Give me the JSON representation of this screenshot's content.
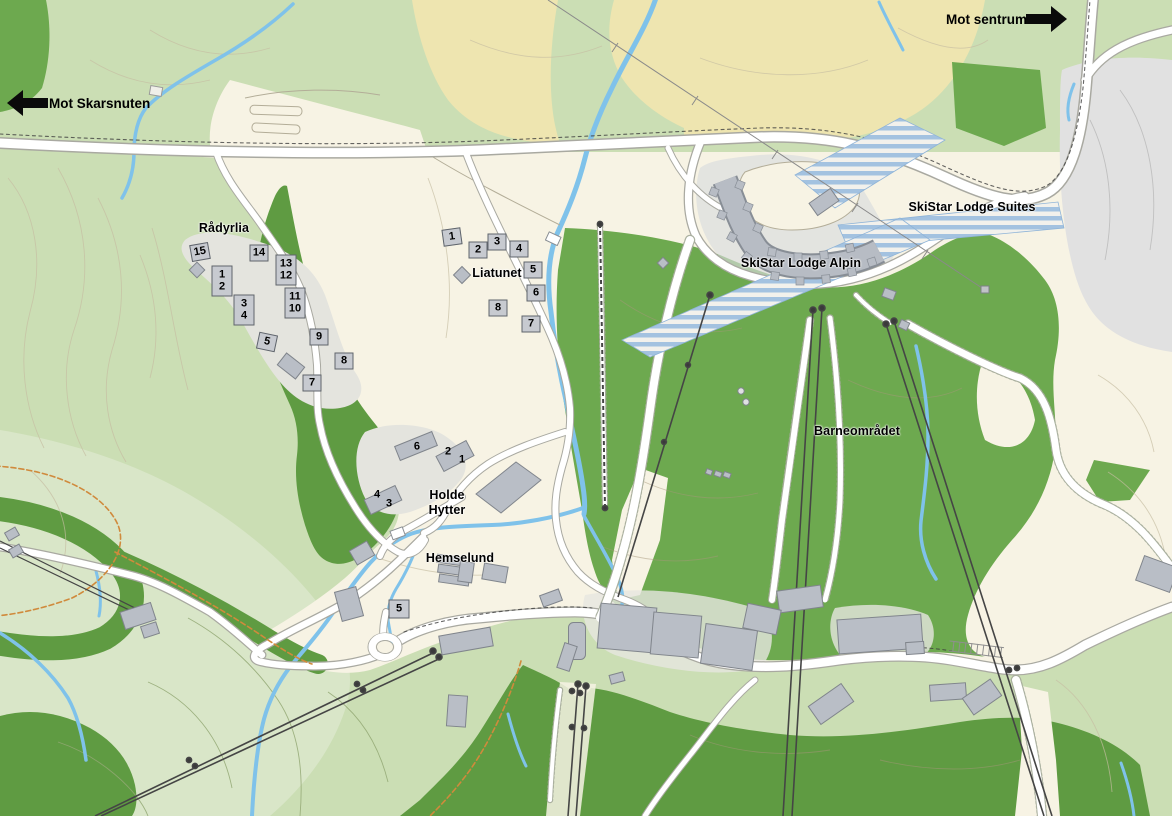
{
  "direction_signs": {
    "skarsnuten": {
      "label": "Mot Skarsnuten",
      "arrow": "left"
    },
    "sentrum": {
      "label": "Mot sentrum",
      "arrow": "right"
    }
  },
  "place_labels": {
    "radyrlia": "Rådyrlia",
    "liatunet": "Liatunet",
    "holde_hytter_line1": "Holde",
    "holde_hytter_line2": "Hytter",
    "hemselund": "Hemselund",
    "skistar_lodge_alpin": "SkiStar Lodge Alpin",
    "skistar_lodge_suites": "SkiStar Lodge Suites",
    "barneomradet": "Barneområdet"
  },
  "cabin_numbers": {
    "radyrlia": [
      "15",
      "14",
      "13",
      "12",
      "1",
      "2",
      "3",
      "4",
      "11",
      "10",
      "5",
      "9",
      "8",
      "7"
    ],
    "liatunet": [
      "1",
      "2",
      "3",
      "4",
      "5",
      "6",
      "8",
      "7"
    ],
    "holde_hytter": [
      "6",
      "2",
      "1",
      "4",
      "3"
    ],
    "hemselund": [
      "5"
    ]
  },
  "colors": {
    "open_land_green": "#cbdeb4",
    "pale_green": "#d9e6c8",
    "ski_slope_green": "#6da94f",
    "forest_green": "#5f9b42",
    "farmland_tan": "#eee5b0",
    "developed_cream": "#f7f3e4",
    "parking_gray": "#e1e1e1",
    "building_gray": "#b9bec6",
    "water_blue": "#7fc2ea",
    "suites_stripe_blue": "#a3c2e0",
    "trail_orange": "#d08a3c",
    "lift_dark": "#454545",
    "label_black": "#000000"
  }
}
